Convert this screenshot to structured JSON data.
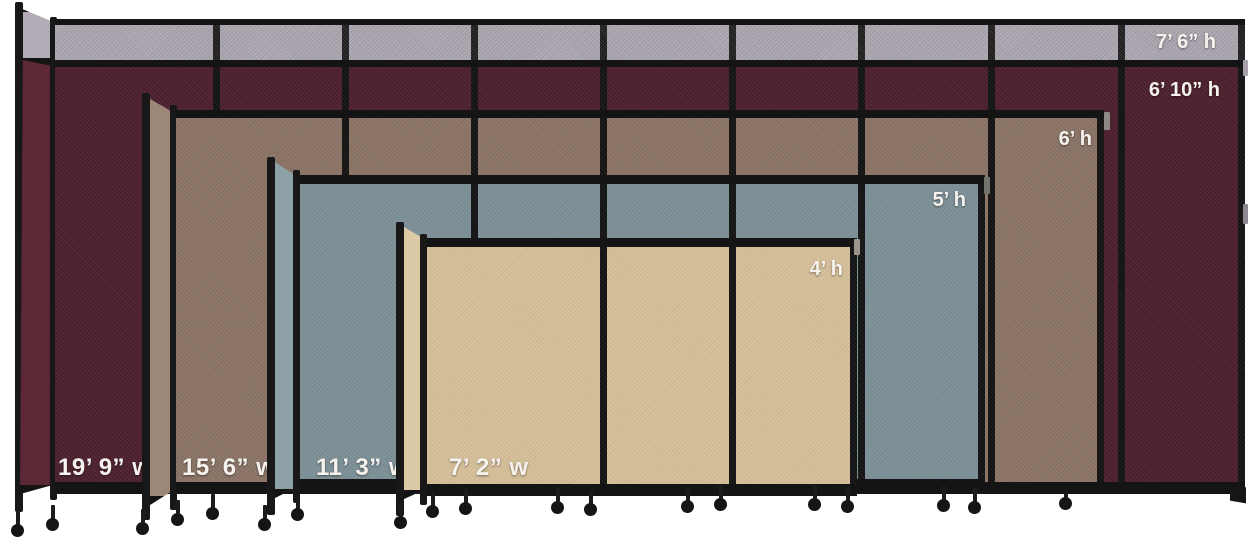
{
  "image_type": "product size comparison image",
  "product": "portable room divider partitions on caster wheels",
  "background_color": "#ffffff",
  "frame_color": "#141414",
  "label_text_color": "#f6f3ee",
  "partitions": [
    {
      "name": "burgundy-partition",
      "fabric_color_hex": "#4c202e",
      "side_color_hex": "#5c2836",
      "top_extension_color_hex": "#a8a1ac",
      "extension_height_label": "7’ 6” h",
      "height_label": "6’ 10” h",
      "width_label": "19’ 9” w"
    },
    {
      "name": "mocha-partition",
      "fabric_color_hex": "#8b7466",
      "side_color_hex": "#9d8777",
      "height_label": "6’ h",
      "width_label": "15’ 6” w"
    },
    {
      "name": "slate-blue-partition",
      "fabric_color_hex": "#7d9097",
      "side_color_hex": "#8da1a6",
      "height_label": "5’ h",
      "width_label": "11’ 3” w"
    },
    {
      "name": "sand-partition",
      "fabric_color_hex": "#d5bf99",
      "side_color_hex": "#dcc9a6",
      "height_label": "4’ h",
      "width_label": "7’ 2” w"
    }
  ]
}
